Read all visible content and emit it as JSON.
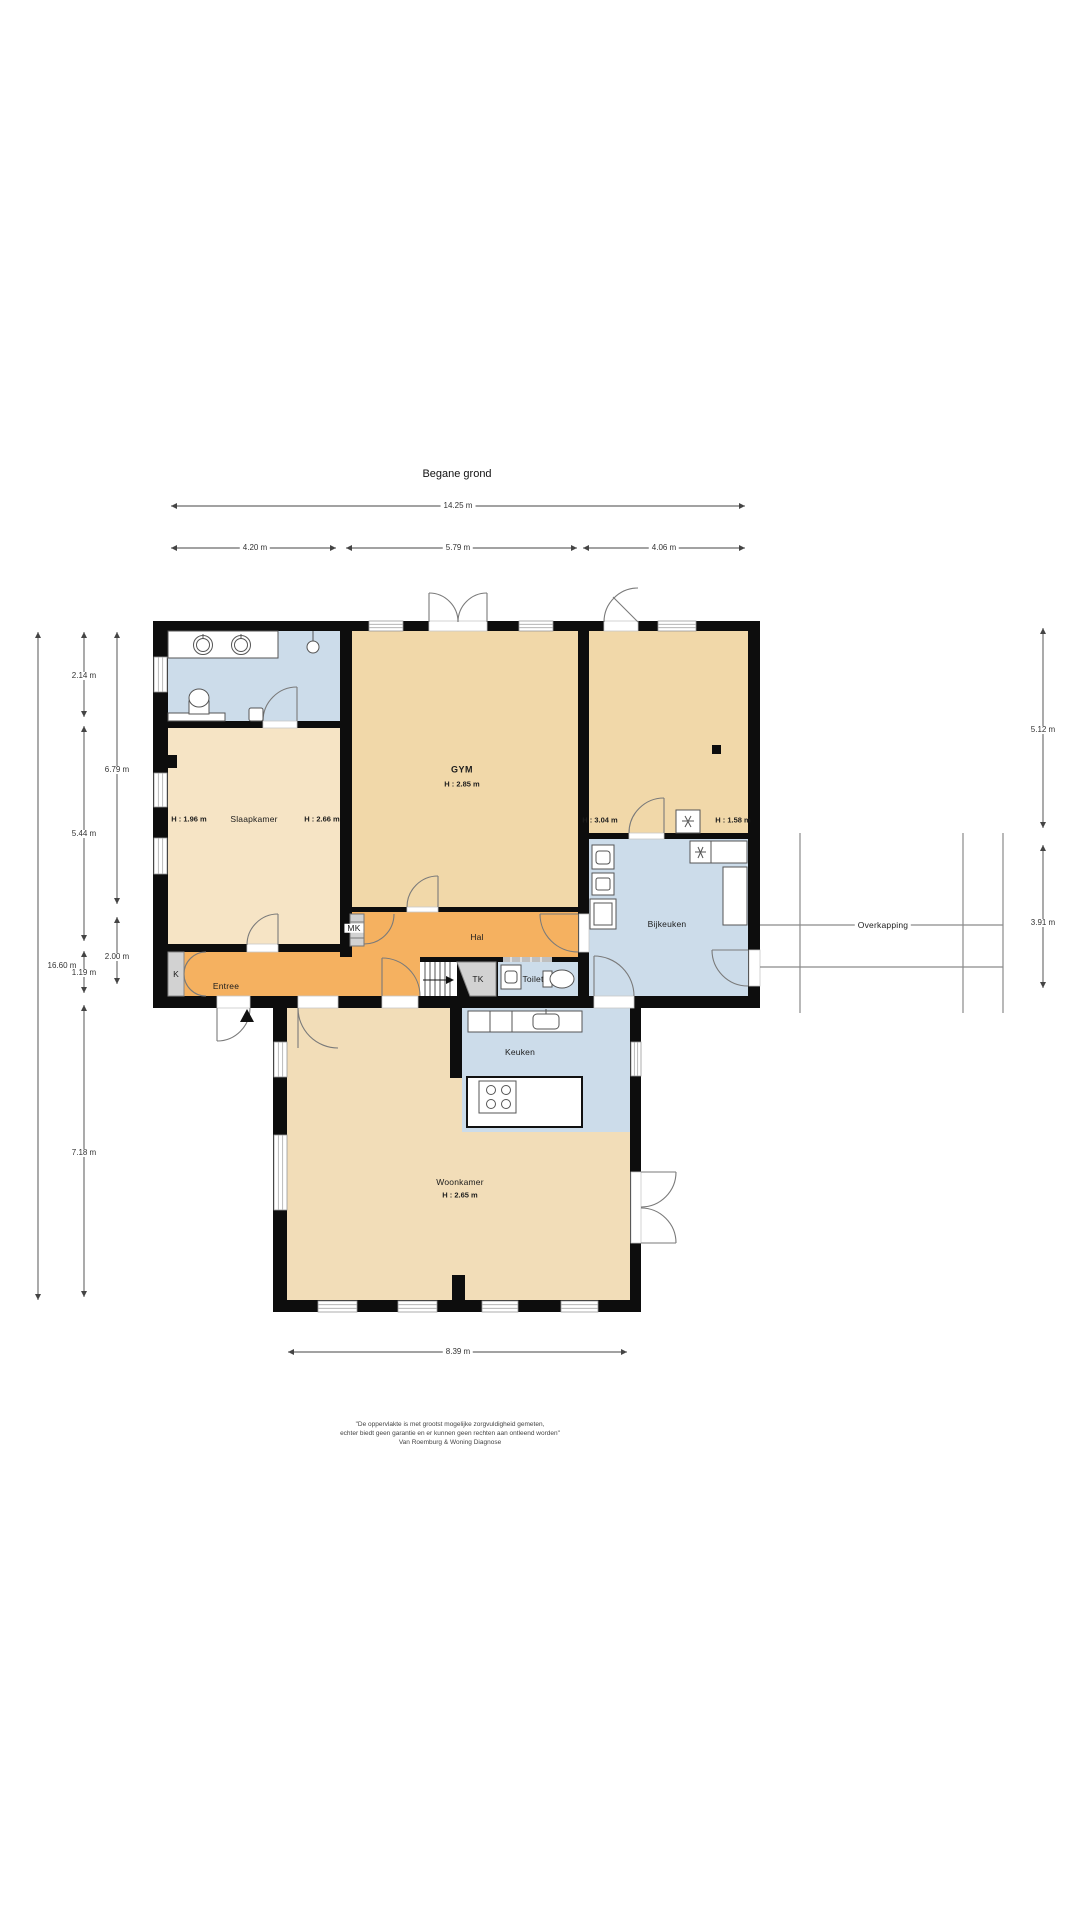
{
  "title": "Begane grond",
  "rooms": {
    "slaapkamer": {
      "name": "Slaapkamer",
      "h_left": "H : 1.96 m",
      "h_right": "H : 2.66 m"
    },
    "gym": {
      "name": "GYM",
      "h": "H : 2.85 m"
    },
    "multi": {
      "h_left": "H : 3.04 m",
      "h_right": "H : 1.58 m"
    },
    "bijkeuken": {
      "name": "Bijkeuken"
    },
    "hal": {
      "name": "Hal"
    },
    "entree": {
      "name": "Entree"
    },
    "kast": {
      "name": "K"
    },
    "meterkast": {
      "name": "MK"
    },
    "trapkast": {
      "name": "TK"
    },
    "toilet": {
      "name": "Toilet"
    },
    "keuken": {
      "name": "Keuken"
    },
    "woonkamer": {
      "name": "Woonkamer",
      "h": "H : 2.65 m"
    },
    "overkapping": {
      "name": "Overkapping"
    }
  },
  "dimensions": {
    "top_total": "14.25 m",
    "top_segments": [
      "4.20 m",
      "5.79 m",
      "4.06 m"
    ],
    "left_total": "16.60 m",
    "left_inner": [
      "2.14 m",
      "5.44 m",
      "1.19 m",
      "7.18 m"
    ],
    "left_outer": [
      "6.79 m",
      "2.00 m"
    ],
    "right": [
      "5.12 m",
      "3.91 m"
    ],
    "bottom": "8.39 m"
  },
  "disclaimer": {
    "line1": "\"De oppervlakte is met grootst mogelijke zorgvuldigheid gemeten,",
    "line2": "echter biedt geen garantie en er kunnen geen rechten aan ontleend worden\"",
    "line3": "Van Roemburg & Woning Diagnose"
  },
  "colors": {
    "wall": "#0d0d0d",
    "beige": "#f1d8a9",
    "beige_light": "#f6e4c5",
    "beige_mid": "#f2ddb8",
    "orange": "#f5b160",
    "blue": "#ccdcea",
    "gray": "#d2d2d2",
    "white": "#ffffff"
  }
}
